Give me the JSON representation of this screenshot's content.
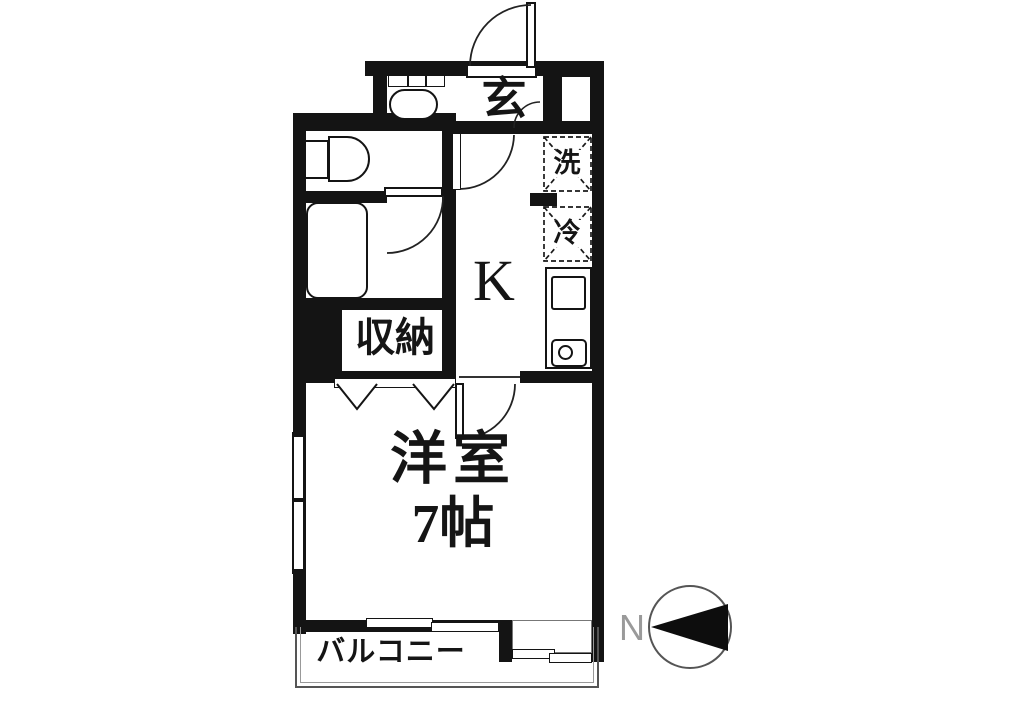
{
  "meta": {
    "type": "apartment-floor-plan"
  },
  "labels": {
    "entrance": "玄",
    "washing_machine": "洗",
    "refrigerator": "冷",
    "kitchen": "K",
    "storage": "収納",
    "room_name": "洋室",
    "room_size": "7帖",
    "balcony": "バルコニー",
    "north": "N"
  },
  "colors": {
    "wall": "#141414",
    "line": "#222222",
    "thin_line": "#777777",
    "balcony_line": "#555555",
    "text": "#151515",
    "north_text": "#9a9a9a",
    "background": "#ffffff"
  }
}
